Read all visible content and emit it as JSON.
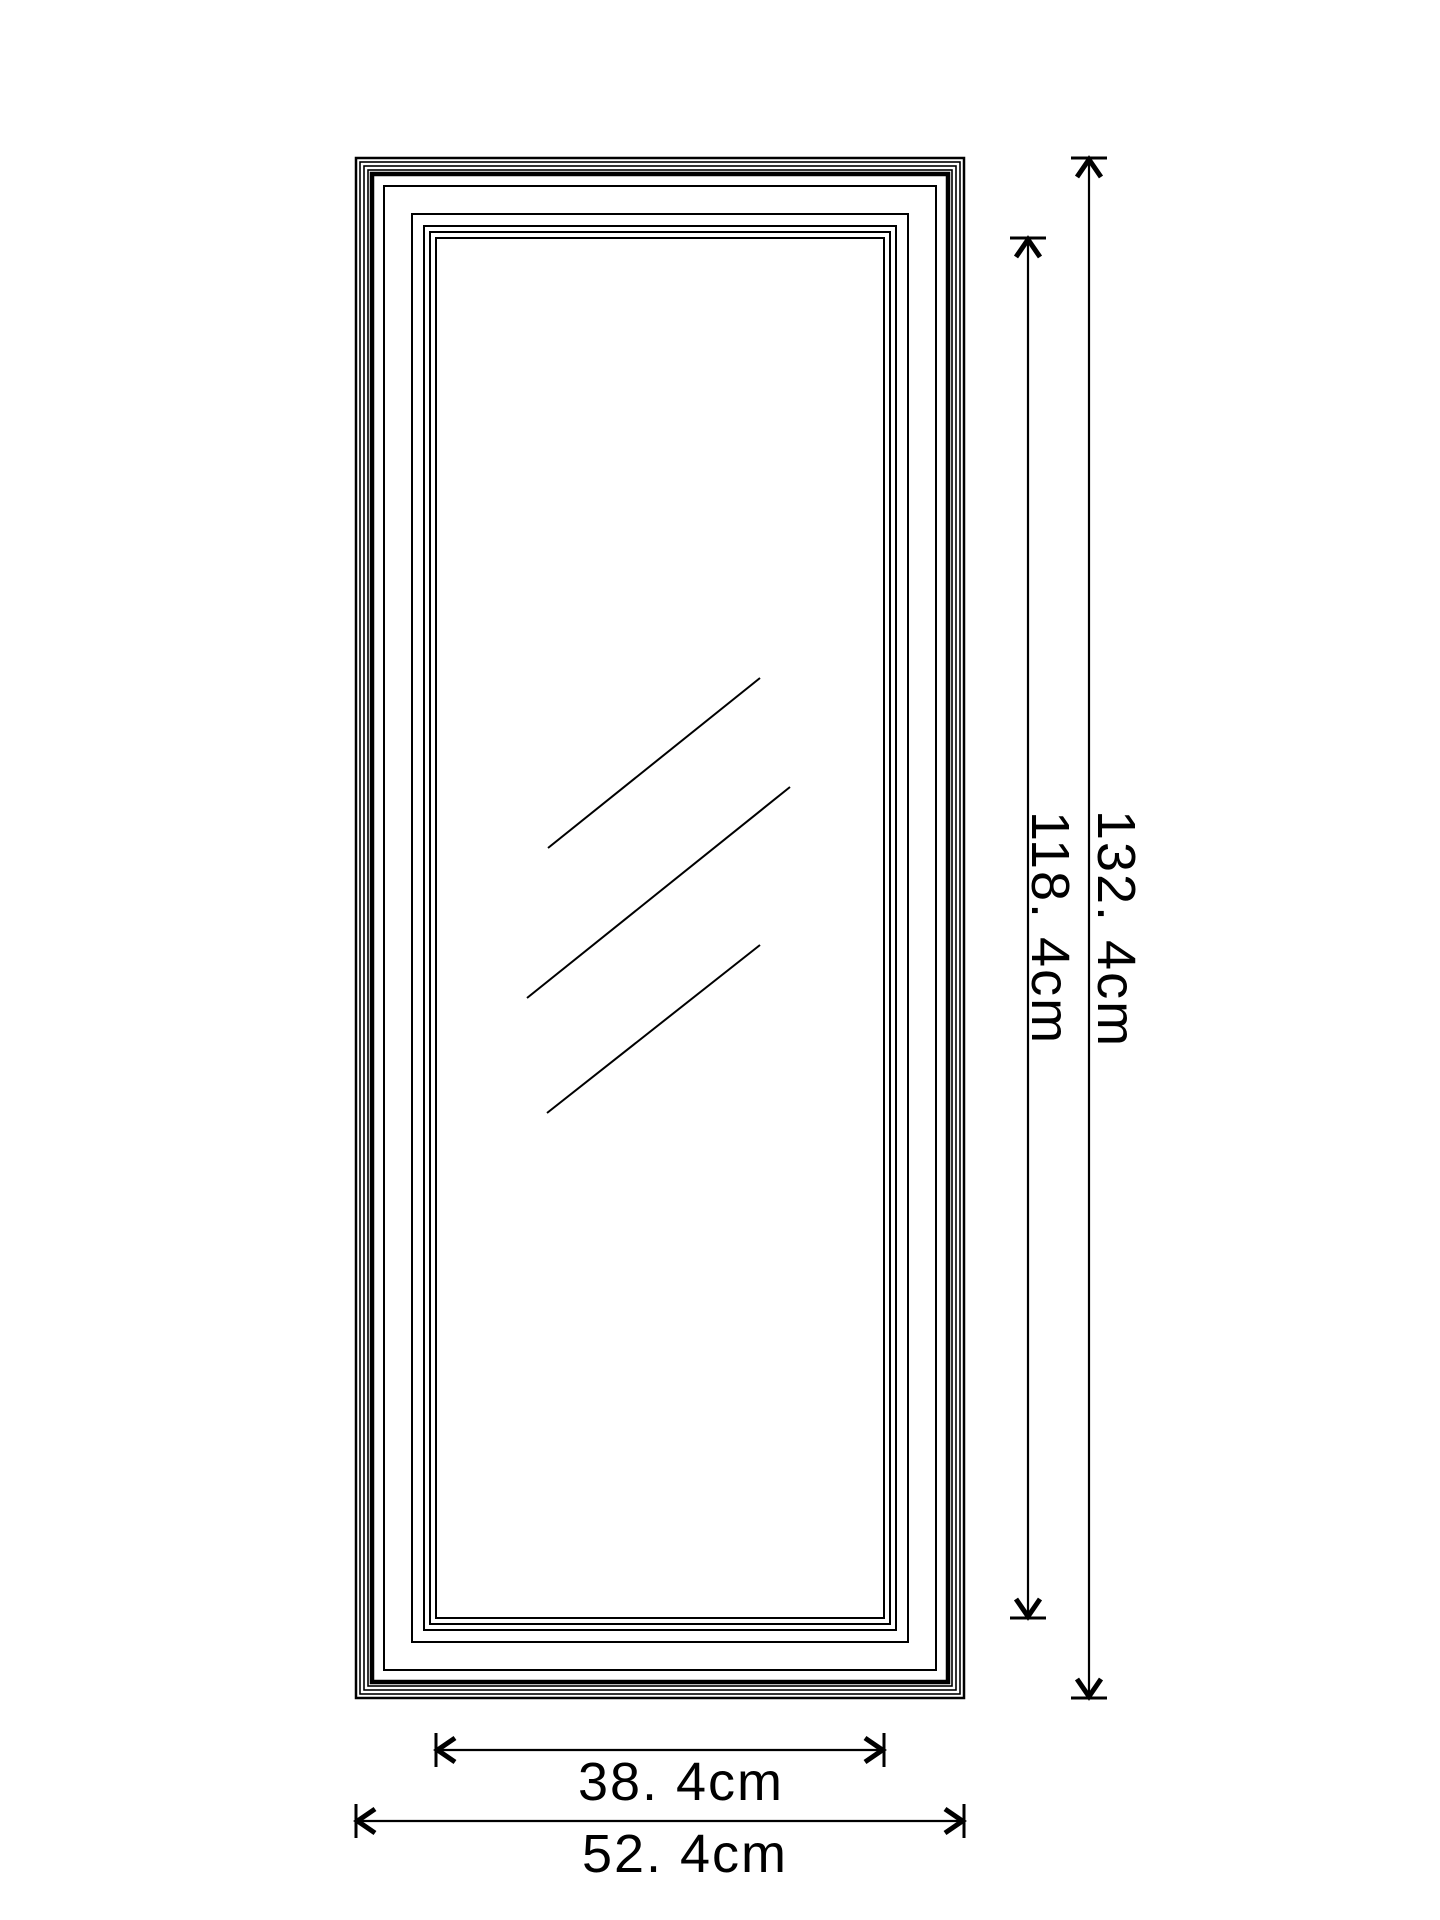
{
  "page": {
    "background_color": "#ffffff",
    "line_color": "#000000"
  },
  "diagram": {
    "type": "product-dimension-drawing",
    "subject": "rectangular framed full-length mirror, front view",
    "labels": {
      "outer_height": "132. 4cm",
      "inner_height": "118. 4cm",
      "inner_width": "38. 4cm",
      "outer_width": "52. 4cm"
    },
    "values_cm": {
      "outer_height": 132.4,
      "inner_height": 118.4,
      "inner_width": 38.4,
      "outer_width": 52.4
    }
  }
}
